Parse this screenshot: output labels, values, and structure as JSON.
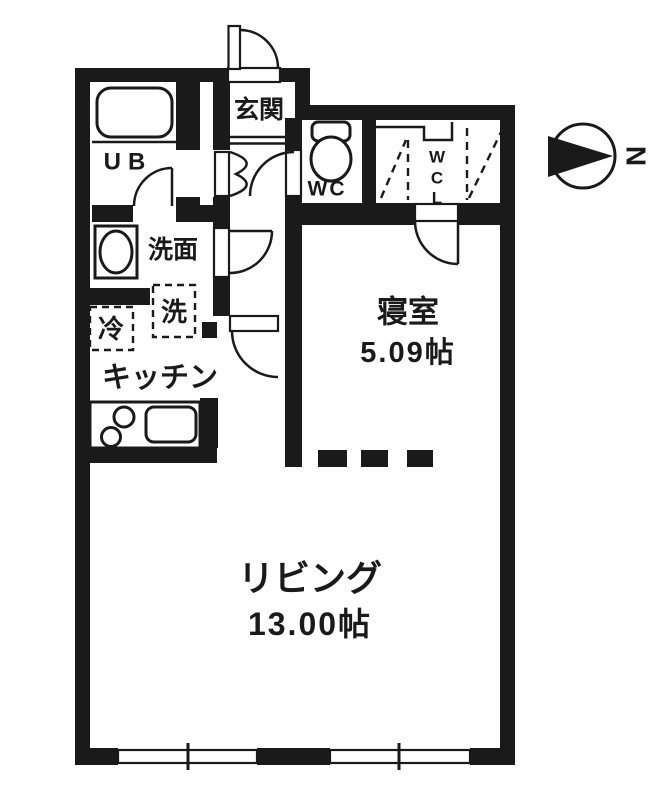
{
  "plan_title": "apartment-floor-plan",
  "rooms": {
    "genkan": {
      "label": "玄関"
    },
    "ub": {
      "label": "UB"
    },
    "wc": {
      "label": "WC"
    },
    "wcl": {
      "letters": [
        "W",
        "C",
        "L"
      ]
    },
    "senmen": {
      "label": "洗面"
    },
    "washer": {
      "label": "洗"
    },
    "fridge": {
      "label": "冷"
    },
    "kitchen": {
      "label": "キッチン"
    },
    "bedroom": {
      "label": "寝室",
      "size": "5.09帖"
    },
    "living": {
      "label": "リビング",
      "size": "13.00帖"
    }
  },
  "compass": {
    "label": "N"
  },
  "colors": {
    "wall": "#1a1a1a",
    "background": "#ffffff"
  }
}
